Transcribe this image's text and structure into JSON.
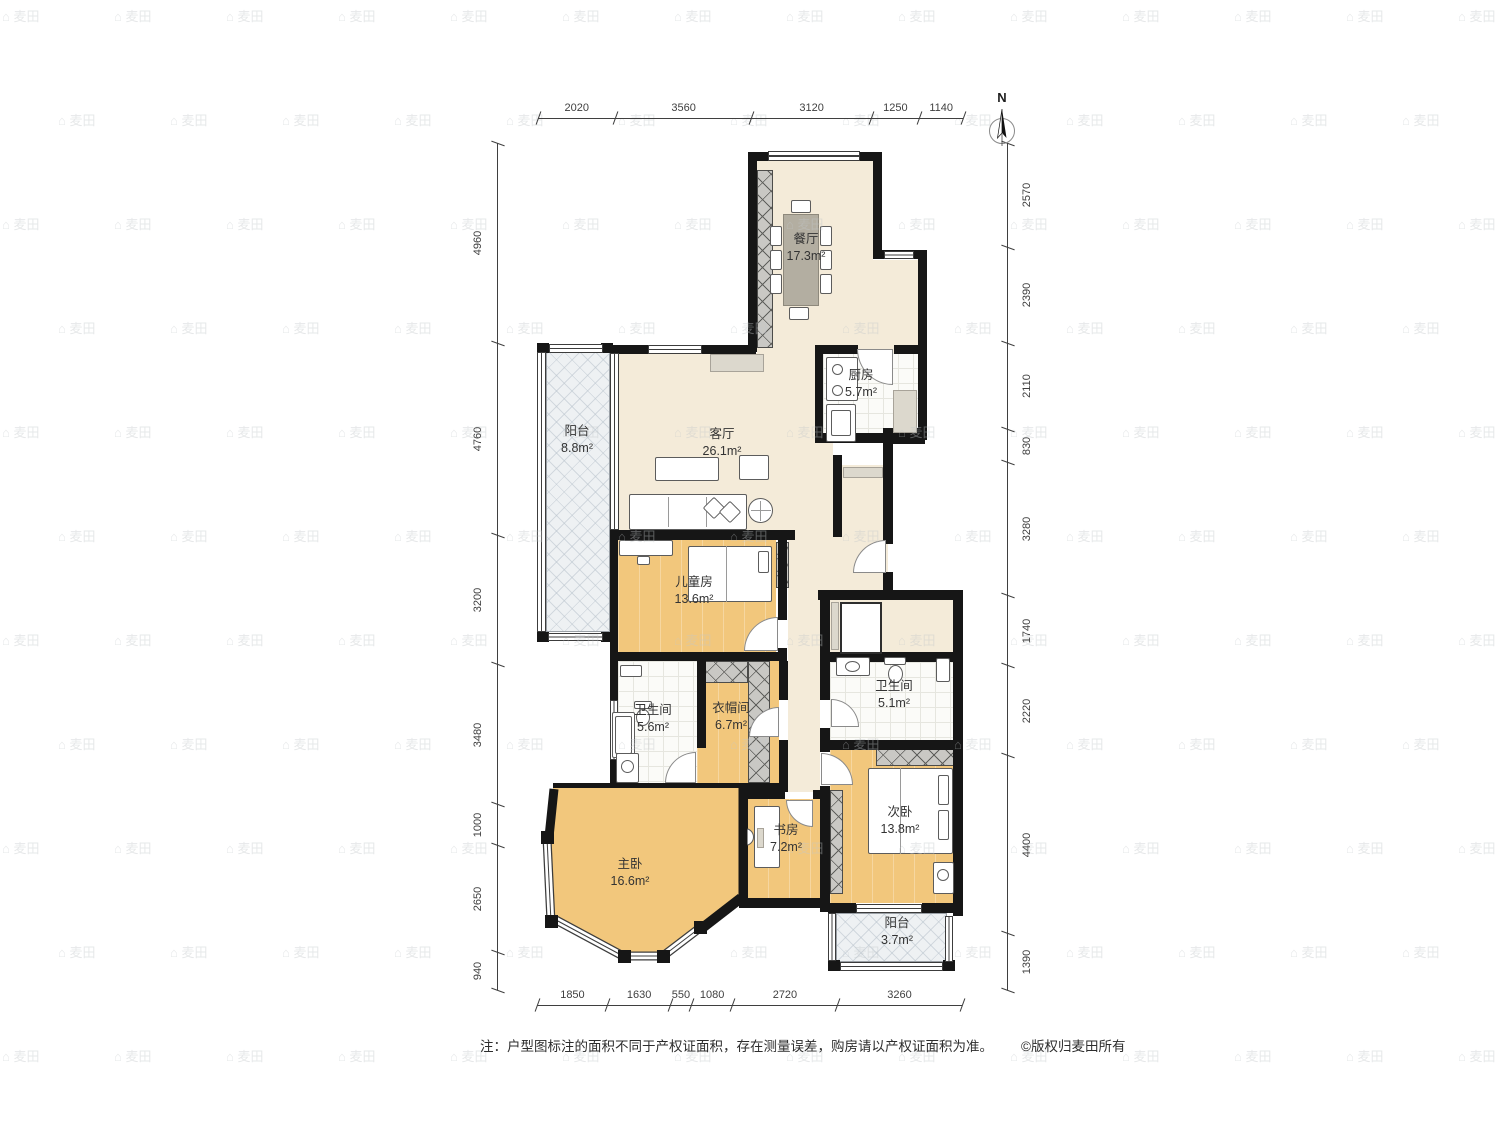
{
  "north": {
    "label": "N"
  },
  "rooms": {
    "dining": {
      "name": "餐厅",
      "area": "17.3m²"
    },
    "living": {
      "name": "客厅",
      "area": "26.1m²"
    },
    "kitchen": {
      "name": "厨房",
      "area": "5.7m²"
    },
    "balcony_top": {
      "name": "阳台",
      "area": "8.8m²"
    },
    "children": {
      "name": "儿童房",
      "area": "13.6m²"
    },
    "bath_a": {
      "name": "卫生间",
      "area": "5.6m²"
    },
    "cloakroom": {
      "name": "衣帽间",
      "area": "6.7m²"
    },
    "bath_b": {
      "name": "卫生间",
      "area": "5.1m²"
    },
    "bedroom2": {
      "name": "次卧",
      "area": "13.8m²"
    },
    "study": {
      "name": "书房",
      "area": "7.2m²"
    },
    "master": {
      "name": "主卧",
      "area": "16.6m²"
    },
    "balcony_bottom": {
      "name": "阳台",
      "area": "3.7m²"
    }
  },
  "dimensions": {
    "top": [
      "2020",
      "3560",
      "3120",
      "1250",
      "1140"
    ],
    "bottom": [
      "1850",
      "1630",
      "550",
      "1080",
      "2720",
      "3260"
    ],
    "left": [
      "4960",
      "4760",
      "3200",
      "3480",
      "1000",
      "2650",
      "940"
    ],
    "right": [
      "2570",
      "2390",
      "2110",
      "830",
      "3280",
      "1740",
      "2220",
      "4400",
      "1390"
    ]
  },
  "footer": {
    "note": "注：户型图标注的面积不同于产权证面积，存在测量误差，购房请以产权证面积为准。",
    "copyright": "©版权归麦田所有"
  },
  "watermark": {
    "icon": "⌂",
    "text": "麦田"
  },
  "colors": {
    "wall": "#161616",
    "wood": "#f2c77c",
    "cream": "#f4ebd9",
    "hatch": "#c9c8c4"
  }
}
